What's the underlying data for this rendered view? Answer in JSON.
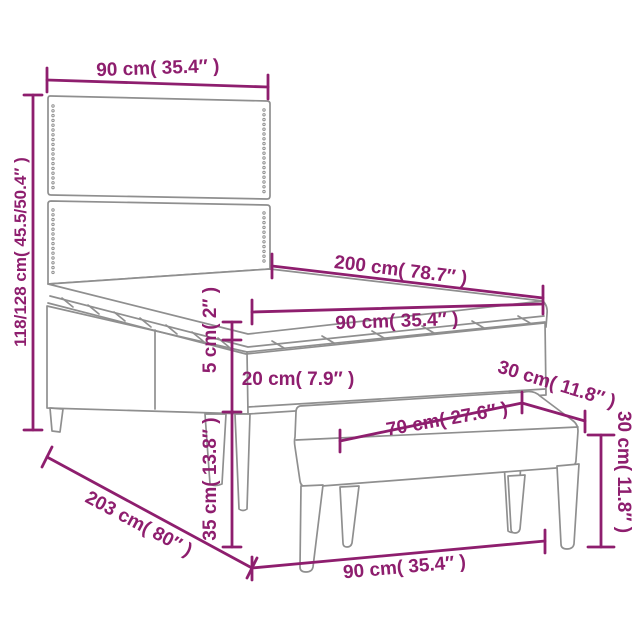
{
  "colors": {
    "accent": "#8E1E6E",
    "line": "#8F8F8F",
    "background": "#FFFFFF"
  },
  "diagram": {
    "labels": {
      "headboard_width": "90 cm( 35.4″ )",
      "headboard_height": "118/128 cm( 45.5/50.4″ )",
      "bed_length": "200 cm( 78.7″ )",
      "mattress_width": "90 cm( 35.4″ )",
      "topper_height": "5 cm( 2″ )",
      "mattress_height": "20 cm( 7.9″ )",
      "base_height": "35 cm( 13.8″ )",
      "bench_depth": "30 cm( 11.8″ )",
      "bench_width": "70 cm( 27.6″ )",
      "bench_height": "30 cm( 11.8″ )",
      "frame_length": "203 cm( 80″ )",
      "frame_width": "90 cm( 35.4″ )"
    }
  }
}
